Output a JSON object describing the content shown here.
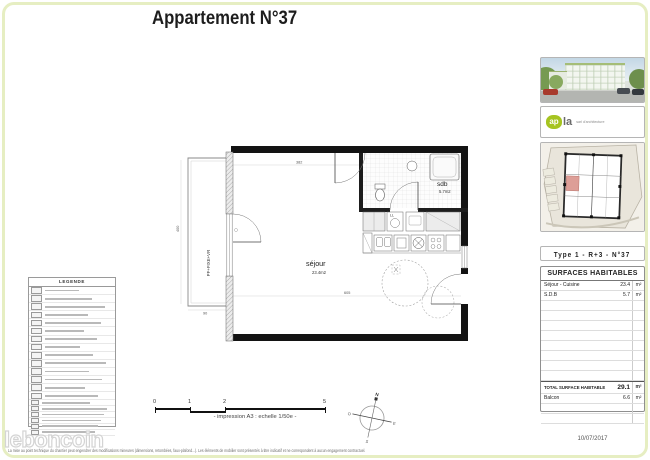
{
  "page": {
    "title": "Appartement N°37",
    "watermark": "leboncoin",
    "disclaimer": "La mise au point technique du chantier peut engendrer des modifications mineures (dimensions, retombées, faux-plafond...). Les éléments de mobilier sont présentés à titre indicatif et ne correspondent à aucun engagement contractuel.",
    "date": "10/07/2017"
  },
  "legend": {
    "title": "LEGENDE",
    "row_count": 14,
    "compact_row_count": 6
  },
  "plan": {
    "sejour_name": "séjour",
    "sejour_area": "23.4m2",
    "sdb_name": "sdb",
    "sdb_area": "5.7m2",
    "washer_label": "LL",
    "window_label": "PF+FIXE+VR",
    "dims": {
      "top": "382",
      "sdb": "223",
      "left": "400",
      "balcony": "90",
      "bottom": "605"
    }
  },
  "scalebar": {
    "ticks": [
      "0",
      "1",
      "2",
      "5"
    ],
    "caption": "- impression A3 : echelle 1/50e -"
  },
  "compass": {
    "n": "N",
    "e": "E",
    "s": "S",
    "o": "O"
  },
  "sidebar": {
    "logo": {
      "text": "ap",
      "text2": "la",
      "subtext": "sarl d'architecture"
    },
    "type_header": "Type 1 - R+3 - N°37",
    "surfaces": {
      "title": "SURFACES HABITABLES",
      "rows": [
        {
          "label": "Séjour - Cuisine",
          "value": "23.4",
          "unit": "m²"
        },
        {
          "label": "S.D.B",
          "value": "5.7",
          "unit": "m²"
        }
      ],
      "empty_rows": 8,
      "total": {
        "label": "TOTAL SURFACE HABITABLE",
        "value": "29.1",
        "unit": "m²"
      },
      "after_rows": [
        {
          "label": "Balcon",
          "value": "6.6",
          "unit": "m²"
        }
      ],
      "trailing_empty_rows": 2
    }
  }
}
